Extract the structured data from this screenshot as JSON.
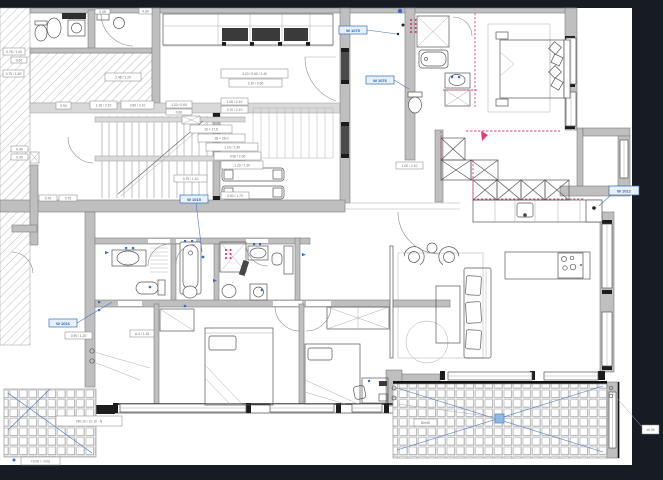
{
  "drawing": {
    "type": "apartment-floor-plan",
    "colors": {
      "background": "#161b24",
      "sheet": "#ffffff",
      "wall": "#bfbfbf",
      "wall_dark": "#7d7d7d",
      "line": "#6f6f6f",
      "accent_blue": "#2f6fc0",
      "accent_red": "#e0457b",
      "black": "#1c1c1c",
      "tile_line": "#c3c3c3"
    }
  },
  "labels": {
    "blue_tags": [
      "W 1075",
      "W 1076",
      "W 1015",
      "W 1016",
      "W 1012"
    ],
    "dims": [
      "2.46 / 1.20",
      "0.90",
      "1.26 / 2.10",
      "0.80 / 2.10",
      "1.20 / 0.60",
      "0.60",
      "1.00 / 2.10",
      "0.70 / 2.10",
      "16 × 17.6",
      "28 × 26.0",
      "1.10 / 2.30",
      "0.90 / 2.30",
      "1.20 / 2.30",
      "0.75 / 1.10",
      "0.60 / 1.70",
      "3.20 / 0.60 / 2.40",
      "2.10 / 0.60",
      "0.45",
      "0.60",
      "0.76 / 1.40",
      "0.60",
      "0.75 / 1.40",
      "0.40",
      "0.40",
      "0.70",
      "0.70",
      "1.00 / 2.10",
      "0.90 / 1.20",
      "A-4 / 1.15",
      "240.10 / 10.10 · N",
      "+0.00 / −0.02",
      "60×60",
      "±0.00"
    ]
  }
}
